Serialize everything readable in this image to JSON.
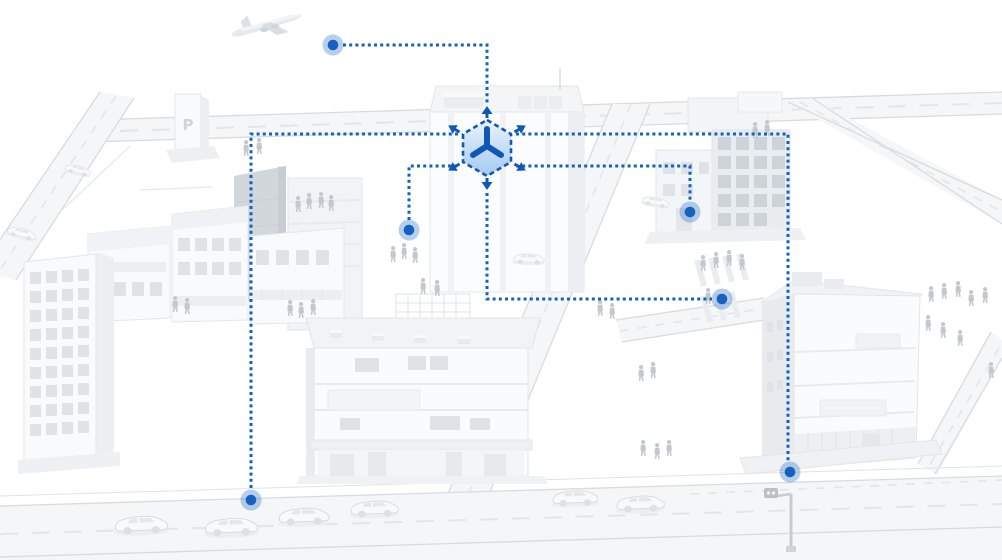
{
  "scene": {
    "description": "3D white city illustration with blue dotted IoT network lines linking city locations to a central 3D-cube hub icon",
    "parking_sign": "P",
    "palette": {
      "accent": "#1461c1",
      "accent-deep": "#0f58b8",
      "cube-fill-top": "#eaf3fc",
      "cube-fill-bottom": "#a4c9f0",
      "building-light": "#f8fafb",
      "building-mid": "#eceff2",
      "building-dark": "#d2d7db",
      "window": "#dfe3e7",
      "window-dark": "#ccd3d9",
      "road-fill": "#f4f6f7",
      "road-edge": "#d8dcdf",
      "lane-dash": "#e3e6e9",
      "people": "#c2c8cd",
      "car-fill": "#f7f9fa",
      "outline": "#dfe3e6"
    },
    "pedestrians": [
      [
        243,
        140
      ],
      [
        256,
        138
      ],
      [
        295,
        196
      ],
      [
        306,
        193
      ],
      [
        318,
        192
      ],
      [
        328,
        195
      ],
      [
        172,
        296
      ],
      [
        184,
        298
      ],
      [
        287,
        300
      ],
      [
        298,
        302
      ],
      [
        310,
        299
      ],
      [
        390,
        246
      ],
      [
        401,
        243
      ],
      [
        412,
        247
      ],
      [
        420,
        278
      ],
      [
        434,
        280
      ],
      [
        597,
        300
      ],
      [
        609,
        303
      ],
      [
        638,
        365
      ],
      [
        650,
        362
      ],
      [
        700,
        255
      ],
      [
        713,
        252
      ],
      [
        726,
        250
      ],
      [
        739,
        254
      ],
      [
        705,
        288
      ],
      [
        640,
        440
      ],
      [
        654,
        443
      ],
      [
        666,
        440
      ],
      [
        752,
        122
      ],
      [
        764,
        120
      ],
      [
        928,
        286
      ],
      [
        941,
        283
      ],
      [
        955,
        281
      ],
      [
        968,
        290
      ],
      [
        982,
        287
      ],
      [
        925,
        315
      ],
      [
        940,
        322
      ],
      [
        957,
        330
      ],
      [
        988,
        362
      ]
    ],
    "cars": [
      {
        "x": 112,
        "y": 512,
        "s": 1.05,
        "r": -2
      },
      {
        "x": 202,
        "y": 514,
        "s": 1.05,
        "r": -2
      },
      {
        "x": 276,
        "y": 504,
        "s": 1.0,
        "r": -2
      },
      {
        "x": 348,
        "y": 497,
        "s": 0.95,
        "r": -2
      },
      {
        "x": 550,
        "y": 487,
        "s": 0.9,
        "r": -2
      },
      {
        "x": 614,
        "y": 492,
        "s": 0.95,
        "r": -2
      },
      {
        "x": 642,
        "y": 192,
        "s": 0.55,
        "r": 10
      },
      {
        "x": 512,
        "y": 250,
        "s": 0.62,
        "r": 2
      },
      {
        "x": 66,
        "y": 160,
        "s": 0.52,
        "r": 14
      },
      {
        "x": 8,
        "y": 222,
        "s": 0.58,
        "r": 14
      }
    ]
  },
  "network": {
    "hub": {
      "id": "cube-hub",
      "icon": "3d-cube-expand-icon",
      "x": 487,
      "y": 148
    },
    "style": {
      "dash": "3 3.2",
      "line_width": 3,
      "dot_radius": 5.3,
      "halo_radius": 10.5,
      "halo_opacity": 0.3
    },
    "nodes": [
      {
        "id": "air-traffic-node",
        "x": 333,
        "y": 45
      },
      {
        "id": "plaza-node",
        "x": 409,
        "y": 230
      },
      {
        "id": "side-street-node",
        "x": 690,
        "y": 212
      },
      {
        "id": "crosswalk-node",
        "x": 722,
        "y": 299
      },
      {
        "id": "southwest-road-node",
        "x": 251,
        "y": 500
      },
      {
        "id": "traffic-signal-node",
        "x": 790,
        "y": 472
      }
    ],
    "edges": [
      {
        "to": "air-traffic-node",
        "points": [
          [
            343,
            45
          ],
          [
            487,
            45
          ],
          [
            487,
            105
          ]
        ]
      },
      {
        "to": "southwest-road-node",
        "points": [
          [
            458,
            134
          ],
          [
            251,
            134
          ],
          [
            251,
            491
          ]
        ]
      },
      {
        "to": "plaza-node",
        "points": [
          [
            409,
            220
          ],
          [
            409,
            166
          ],
          [
            458,
            166
          ]
        ]
      },
      {
        "to": "side-street-node",
        "points": [
          [
            516,
            166
          ],
          [
            690,
            166
          ],
          [
            690,
            202
          ]
        ]
      },
      {
        "to": "traffic-signal-node",
        "points": [
          [
            516,
            134
          ],
          [
            788,
            134
          ],
          [
            788,
            462
          ]
        ]
      },
      {
        "to": "crosswalk-node",
        "points": [
          [
            487,
            193
          ],
          [
            487,
            299
          ],
          [
            712,
            299
          ]
        ]
      }
    ]
  }
}
